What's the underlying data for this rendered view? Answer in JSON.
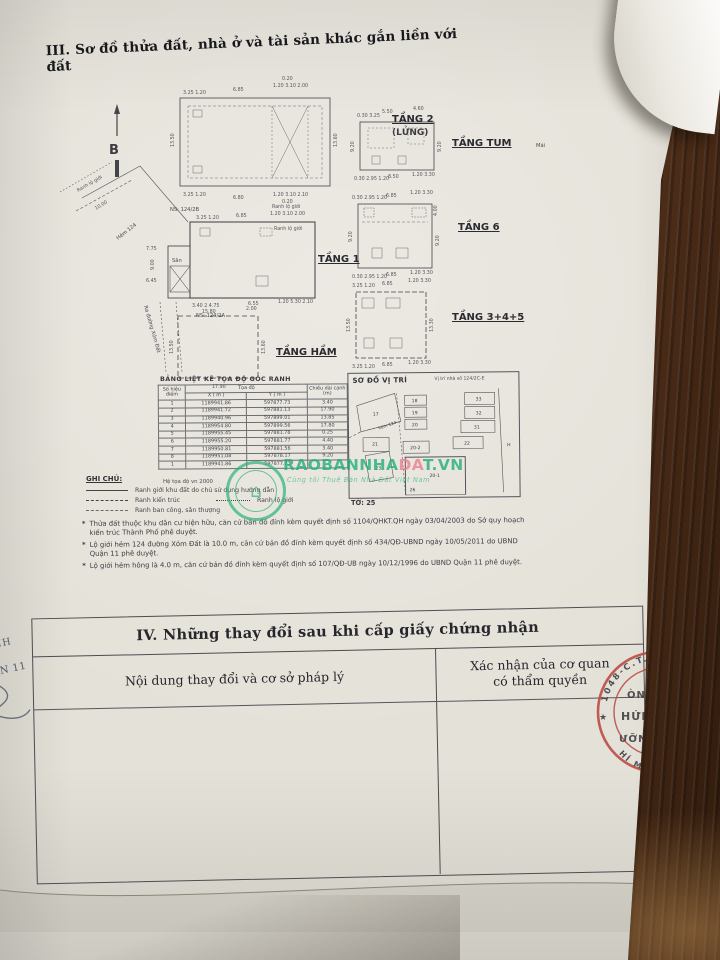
{
  "section3": {
    "title": "III. Sơ đồ thửa đất, nhà ở và tài sản khác gắn liền với đất",
    "north_label": "B",
    "plans": {
      "tang2": {
        "name": "TẦNG 2",
        "name2": "(LỬNG)",
        "dims": {
          "top1": "3.25 1.20",
          "top2": "6.85",
          "top3": "0.20",
          "top4": "1.20 3.10 2.00",
          "left": "13.50",
          "right": "13.60",
          "bot1": "3.25 1.20",
          "bot2": "6.80",
          "bot3": "1.20 3.10 2.10",
          "bot4": "0.20"
        }
      },
      "tum": {
        "name": "TẦNG TUM",
        "side": "Mái",
        "dims": {
          "top1": "0.30 3.25",
          "top2": "5.50",
          "top3": "4.60",
          "left": "9.20",
          "right": "9.20",
          "bot1": "0.30 2.95 1.20",
          "bot2": "8.50",
          "bot3": "1.20 3.30"
        }
      },
      "tang6": {
        "name": "TẦNG 6",
        "dims": {
          "top1": "0.30 2.95 1.20",
          "top2": "6.85",
          "top3": "1.20 3.30",
          "right_top": "4.00",
          "left": "9.20",
          "right": "9.20",
          "bot1": "0.30 2.95 1.20",
          "bot2": "6.85",
          "bot3": "1.20 3.30"
        }
      },
      "tang345": {
        "name": "TẦNG 3+4+5",
        "dims": {
          "top1": "3.25 1.20",
          "top2": "6.85",
          "top3": "1.20 3.30",
          "left": "13.50",
          "right": "13.30",
          "bot1": "3.25 1.20",
          "bot2": "6.85",
          "bot3": "1.20 3.30"
        }
      },
      "tang1": {
        "name": "TẦNG 1",
        "ns_top": "NS: 124/2B",
        "ns_bottom": "NS: 124/2A",
        "san": "Sân",
        "hem": "Hẻm 124",
        "ranh_lo_gioi": "Ranh lộ giới",
        "street": "Ra đường Xóm Đất",
        "dims": {
          "top1": "3.25 1.20",
          "top2": "6.85",
          "top3": "1.20 3.10 2.00",
          "bot1": "3.40 2 4.75",
          "bot2": "6.55",
          "bot3": "1.20 5.30 2.10",
          "d1": "7.75",
          "d2": "9.00",
          "d3": "6.45",
          "d4": "10.00"
        }
      },
      "ham": {
        "name": "TẦNG HẦM",
        "dims": {
          "top1": "15.80",
          "top2": "2.00",
          "left": "13.50",
          "right": "13.60",
          "bot": "17.90"
        }
      }
    },
    "coord_table": {
      "title": "BẢNG LIỆT KÊ TỌA ĐỘ GÓC RANH",
      "col_point": "Số hiệu điểm",
      "col_coord": "Tọa độ",
      "col_x": "X ( m )",
      "col_y": "Y ( m )",
      "col_len": "Chiều dài cạnh (m)",
      "rows": [
        [
          "1",
          "1189941.86",
          "597877.73",
          "3.40"
        ],
        [
          "2",
          "1189941.72",
          "597881.13",
          "17.90"
        ],
        [
          "3",
          "1189940.96",
          "597899.01",
          "13.85"
        ],
        [
          "4",
          "1189954.80",
          "597899.56",
          "17.80"
        ],
        [
          "5",
          "1189955.45",
          "597881.78",
          "0.25"
        ],
        [
          "6",
          "1189955.20",
          "597881.77",
          "4.40"
        ],
        [
          "7",
          "1189950.81",
          "597881.56",
          "3.40"
        ],
        [
          "8",
          "1189951.08",
          "597878.17",
          "9.20"
        ],
        [
          "1",
          "1189941.86",
          "597877.73",
          ""
        ]
      ]
    },
    "location_map": {
      "title": "SƠ ĐỒ VỊ TRÍ",
      "subtitle": "Vị trí nhà số 124/2C-E",
      "sheet": "TỜ: 25",
      "hem": "hẻm 124",
      "parcels": [
        "17",
        "18",
        "19",
        "20",
        "33",
        "32",
        "31",
        "21",
        "20-2",
        "22",
        "23",
        "20-1",
        "26",
        "H"
      ]
    },
    "legend": {
      "heading": "GHI CHÚ:",
      "datum": "Hệ tọa độ vn 2000",
      "item1": "Ranh giới khu đất do chủ sử dụng hướng dẫn",
      "item2": "Ranh kiến trúc",
      "item3": "Ranh lộ giới",
      "item4": "Ranh ban công, sân thượng"
    },
    "notes": [
      "Thửa đất thuộc khu dân cư hiện hữu, căn cứ bản đồ đính kèm quyết định số 1104/QHKT.QH ngày 03/04/2003 do Sở quy hoạch kiến trúc Thành Phố phê duyệt.",
      "Lộ giới hẻm 124 đường Xóm Đất là 10.0 m, căn cứ bản đồ đính kèm quyết định số 434/QĐ-UBND ngày 10/05/2011 do UBND Quận 11 phê duyệt.",
      "Lộ giới hẻm hông là 4.0 m, căn cứ bản đồ đính kèm quyết định số 107/QĐ-UB ngày 10/12/1996 do UBND Quận 11 phê duyệt."
    ]
  },
  "section4": {
    "title": "IV. Những thay đổi sau khi cấp giấy chứng nhận",
    "col1": "Nội dung thay đổi và cơ sở pháp lý",
    "col2_line1": "Xác nhận của cơ quan",
    "col2_line2": "có thẩm quyền"
  },
  "watermark": {
    "brand1": "RAOBANNHA",
    "brand2": "DA",
    "brand3": "T.VN",
    "tagline": "Cùng tôi Thuê Bán Nhà Đất Việt Nam",
    "logo_glyph": "⌂"
  },
  "stamp": {
    "arc_top": "1048-C.T.H.Đ",
    "arc_bottom": "HÍ MINH",
    "star": "★",
    "frag1": "ÒNG",
    "frag2": "HỨNG",
    "frag3": "ƯỠNG"
  },
  "left_margin": {
    "frag1": "MINH",
    "frag2": "UẬN 11"
  },
  "colors": {
    "brand_teal": "#1fae78",
    "brand_pink": "#ef7d8e",
    "stamp_red": "#b94a42",
    "wood": "#4a2c1a"
  }
}
